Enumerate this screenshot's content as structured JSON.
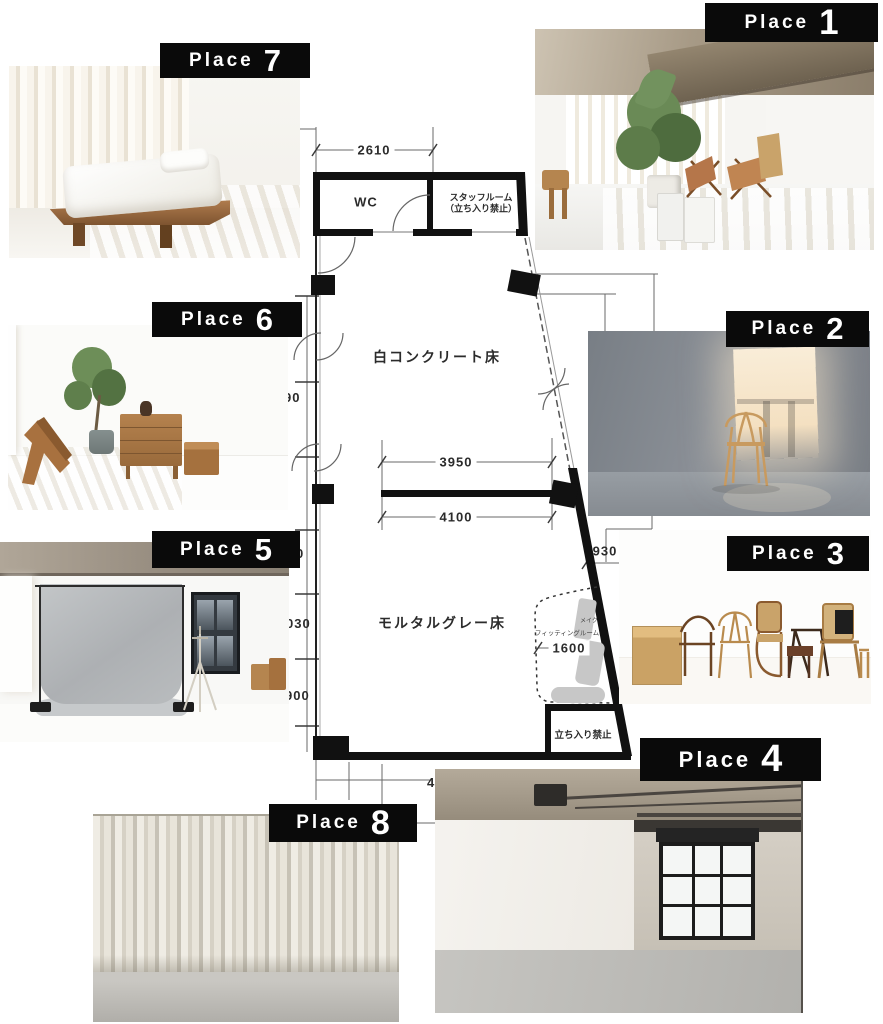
{
  "page": {
    "title": "studio floor plan with place photos"
  },
  "colors": {
    "label_bg": "#0a0a0a",
    "label_text": "#ffffff",
    "wall": "#111111",
    "dim_text": "#2b2b2b",
    "wood_accent": "#a8713f",
    "plant_green": "#5d7c4a",
    "concrete_gray": "#8b9097",
    "backdrop_gray": "#b9bcbe",
    "curtain_beige": "#e6e2d8"
  },
  "places": [
    {
      "label": "Place",
      "number": "1"
    },
    {
      "label": "Place",
      "number": "2"
    },
    {
      "label": "Place",
      "number": "3"
    },
    {
      "label": "Place",
      "number": "4"
    },
    {
      "label": "Place",
      "number": "5"
    },
    {
      "label": "Place",
      "number": "6"
    },
    {
      "label": "Place",
      "number": "7"
    },
    {
      "label": "Place",
      "number": "8"
    }
  ],
  "floorplan": {
    "dim_top": "2610",
    "room_wc": "WC",
    "room_staff_line1": "スタッフルーム",
    "room_staff_line2": "（立ち入り禁止）",
    "floor_white": "白コンクリート床",
    "dim_3950": "3950",
    "dim_4100": "4100",
    "dim_930": "930",
    "floor_gray": "モルタルグレー床",
    "fitting_room": "フィッティングルーム",
    "makeup": "メイク",
    "dim_1600": "1600",
    "no_entry": "立ち入り禁止",
    "dim_bottom_partial": "4",
    "left_fragments": [
      "90",
      "0",
      "030",
      "900"
    ]
  }
}
